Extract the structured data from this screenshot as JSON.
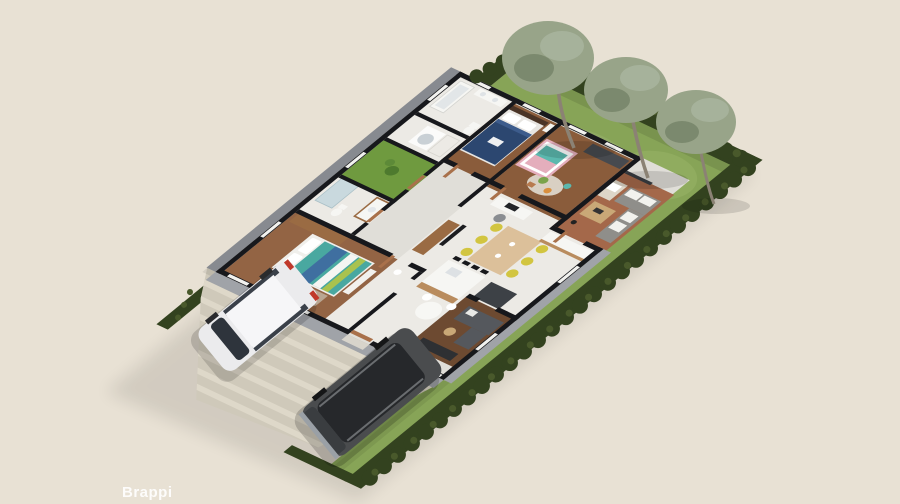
{
  "watermark": {
    "text": "Brappi"
  },
  "palette": {
    "background": "#e8e1d4",
    "hedge": "#33421f",
    "hedge_light": "#49592b",
    "grass": "#87a457",
    "grass_light": "#9ab368",
    "tree": "#98a489",
    "tree_dark": "#6f7d63",
    "trunk": "#8b8274",
    "wall": "#17181c",
    "wall_face": "#a0a3a8",
    "wall_face_dark": "#878a90",
    "slab": "#e0ded8",
    "tile": "#eceae5",
    "wood": "#8a5c3b",
    "wood_master": "#936444",
    "wood_dark": "#6d4a31",
    "patio": "#a4684a",
    "court": "#6f9a3f",
    "driveway": "#cfc9ba",
    "paving": "#ded8c9",
    "van": "#ebebed",
    "suv": "#4a4c4e",
    "glass": "#2e343c",
    "bed_blue": "#2c4770",
    "bed_teal": "#49a8a0",
    "stripe_lime": "#a9c24e",
    "crib_pink": "#e4aebc",
    "crib_teal": "#5bb8ae",
    "sofa_gray": "#8f8e8a",
    "sofa_dark": "#55585d",
    "credenza": "#2e3033",
    "chair_yellow": "#d2c540",
    "table_wood": "#dcc09a",
    "coffee_wood": "#c9a877",
    "cabinet_wood": "#9a6b43",
    "island_wood": "#b98c5e",
    "fixture_white": "#f6f6f3",
    "appliance": "#3d4146",
    "shower_glass": "#c3d7dd"
  },
  "scene": {
    "kind": "3d-floor-plan-render",
    "rooms": [
      "bedroom-blue",
      "kids-bedroom",
      "bathroom-top",
      "laundry",
      "inner-court",
      "bathroom-2",
      "master-bedroom",
      "dining-kitchen",
      "patio-living",
      "tv-room",
      "hallway"
    ],
    "outdoor": [
      "backyard-lawn",
      "birch-trees",
      "perimeter-hedge",
      "driveway",
      "white-minivan",
      "dark-suv"
    ]
  }
}
